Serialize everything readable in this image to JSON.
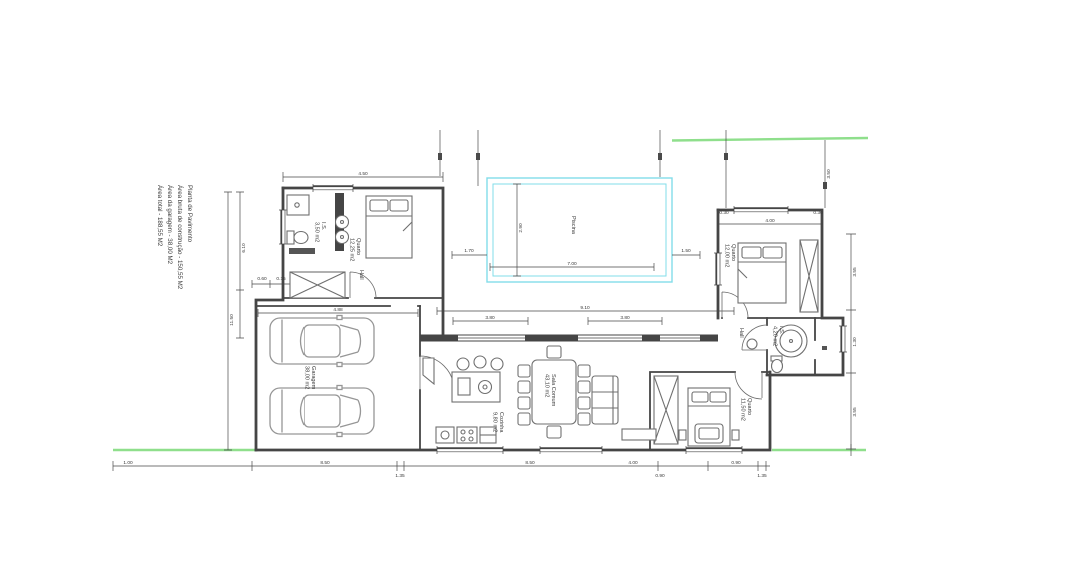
{
  "meta": {
    "title": "Planta de Pavimento"
  },
  "colors": {
    "boundary": "#8fdf8c",
    "pool": "#82dde9",
    "wall": "#454545",
    "dim": "#4a4a4a",
    "furn": "#6f6f6f",
    "car": "#969696",
    "txt": "#3a3a3a"
  },
  "legend": {
    "title": "Planta de Pavimento",
    "areas": [
      {
        "label": "Área bruta de construção",
        "value": "- 150,55 M2"
      },
      {
        "label": "Área da garagem",
        "value": "- 38,00 M2"
      },
      {
        "label": "Área total",
        "value": "- 188,55 M2"
      }
    ]
  },
  "rooms": [
    {
      "lines": [
        "I.S.",
        "3,50 m2"
      ],
      "x": 322,
      "y": 222
    },
    {
      "lines": [
        "Quarto",
        "12,25 m2"
      ],
      "x": 357,
      "y": 238
    },
    {
      "lines": [
        "Hall"
      ],
      "x": 360,
      "y": 270
    },
    {
      "lines": [
        "Piscina"
      ],
      "x": 572,
      "y": 216
    },
    {
      "lines": [
        "Garagem",
        "38,00 m2"
      ],
      "x": 312,
      "y": 366
    },
    {
      "lines": [
        "Cozinha",
        "9,80 m2"
      ],
      "x": 500,
      "y": 412
    },
    {
      "lines": [
        "Sala Comum",
        "43,10 m2"
      ],
      "x": 552,
      "y": 374
    },
    {
      "lines": [
        "Quarto",
        "12,00 m2"
      ],
      "x": 732,
      "y": 244
    },
    {
      "lines": [
        "Hall"
      ],
      "x": 740,
      "y": 328
    },
    {
      "lines": [
        "I.S.",
        "4,20 m2"
      ],
      "x": 780,
      "y": 326
    },
    {
      "lines": [
        "Quarto",
        "11,50 m2"
      ],
      "x": 748,
      "y": 398
    }
  ],
  "dimensions": [
    {
      "t": "4.50",
      "x": 363,
      "y": 175
    },
    {
      "t": "11.50",
      "x": 233,
      "y": 320,
      "r": -90
    },
    {
      "t": "6.10",
      "x": 245,
      "y": 248,
      "r": -90
    },
    {
      "t": "0.60",
      "x": 262,
      "y": 280
    },
    {
      "t": "0.15",
      "x": 281,
      "y": 280
    },
    {
      "t": "4.88",
      "x": 338,
      "y": 311
    },
    {
      "t": "7.00",
      "x": 572,
      "y": 265
    },
    {
      "t": "2.90",
      "x": 522,
      "y": 228,
      "r": -90
    },
    {
      "t": "1.70",
      "x": 469,
      "y": 252
    },
    {
      "t": "1.50",
      "x": 686,
      "y": 252
    },
    {
      "t": "9.10",
      "x": 585,
      "y": 309
    },
    {
      "t": "3.80",
      "x": 490,
      "y": 319
    },
    {
      "t": "3.80",
      "x": 625,
      "y": 319
    },
    {
      "t": "4.00",
      "x": 770,
      "y": 222
    },
    {
      "t": "0.30",
      "x": 724,
      "y": 214
    },
    {
      "t": "0.30",
      "x": 818,
      "y": 214
    },
    {
      "t": "3.50",
      "x": 830,
      "y": 174,
      "r": -90
    },
    {
      "t": "3.55",
      "x": 856,
      "y": 272,
      "r": -90
    },
    {
      "t": "1.30",
      "x": 856,
      "y": 342,
      "r": -90
    },
    {
      "t": "3.55",
      "x": 856,
      "y": 412,
      "r": -90
    },
    {
      "t": "1.00",
      "x": 128,
      "y": 464
    },
    {
      "t": "8.50",
      "x": 325,
      "y": 464
    },
    {
      "t": "8.50",
      "x": 530,
      "y": 464
    },
    {
      "t": "4.00",
      "x": 633,
      "y": 464
    },
    {
      "t": "0.90",
      "x": 736,
      "y": 464
    },
    {
      "t": "1.35",
      "x": 400,
      "y": 477
    },
    {
      "t": "0.90",
      "x": 660,
      "y": 477
    },
    {
      "t": "1.35",
      "x": 762,
      "y": 477
    }
  ]
}
